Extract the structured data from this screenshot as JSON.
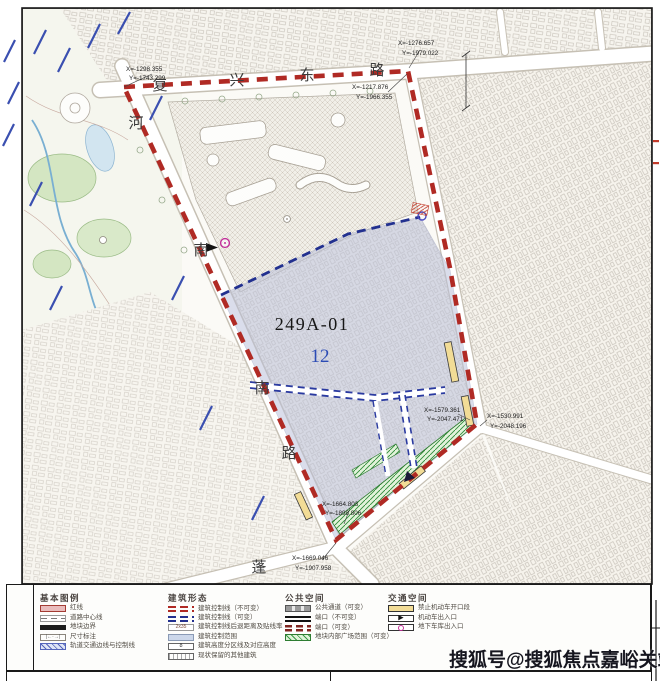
{
  "map": {
    "parcel_code": "249A-01",
    "parcel_number": "12",
    "road_names": {
      "top": [
        "复",
        "兴",
        "东",
        "路"
      ],
      "west": [
        "河",
        "南",
        "南",
        "路"
      ],
      "south": [
        "蓬"
      ]
    },
    "coordinate_labels": [
      {
        "x": "X=-1298.355",
        "y": "Y=-1743.299"
      },
      {
        "x": "X=-1276.657",
        "y": "Y=-1979.022"
      },
      {
        "x": "X=-1217.876",
        "y": "Y=-1966.355"
      },
      {
        "x": "X=-1579.361",
        "y": "Y=-2047.471"
      },
      {
        "x": "X=-1530.991",
        "y": "Y=-2048.196"
      },
      {
        "x": "X=-1664.803",
        "y": "Y=-1898.806"
      },
      {
        "x": "X=-1669.046",
        "y": "Y=-1907.958"
      }
    ]
  },
  "legend": {
    "side_label": [
      "图",
      "例"
    ],
    "sections": [
      {
        "title": "基本图例",
        "items": [
          {
            "label": "红线"
          },
          {
            "label": "道路中心线"
          },
          {
            "label": "地块边界"
          },
          {
            "label": "尺寸标注"
          },
          {
            "label": "轨道交通边线与控制线"
          }
        ]
      },
      {
        "title": "建筑形态",
        "items": [
          {
            "label": "建筑控制线（不可变）"
          },
          {
            "label": "建筑控制线（可变）"
          },
          {
            "label": "建筑控制线后退距离及贴线率",
            "swatch_text": "2x35"
          },
          {
            "label": "建筑控制范围"
          },
          {
            "label": "建筑高度分区线及对应高度",
            "swatch_text": "8"
          },
          {
            "label": "现状保留的其他建筑"
          }
        ]
      },
      {
        "title": "公共空间",
        "items": [
          {
            "label": "公共通道（可变）"
          },
          {
            "label": "端口（不可变）"
          },
          {
            "label": "端口（可变）"
          },
          {
            "label": "地块内部广场范围（可变）"
          }
        ]
      },
      {
        "title": "交通空间",
        "items": [
          {
            "label": "禁止机动车开口段"
          },
          {
            "label": "机动车出入口",
            "icon": "▶"
          },
          {
            "label": "地下车库出入口"
          }
        ]
      }
    ]
  },
  "watermark": "搜狐号@搜狐焦点嘉峪关站",
  "colors": {
    "boundary_red": "#b02a24",
    "control_blue": "#22308f",
    "site_lavender": "#b9bfd9",
    "plaza_green": "#3a9a46",
    "no_opening_yellow": "#f2dc96",
    "garage_magenta": "#c2309a"
  }
}
